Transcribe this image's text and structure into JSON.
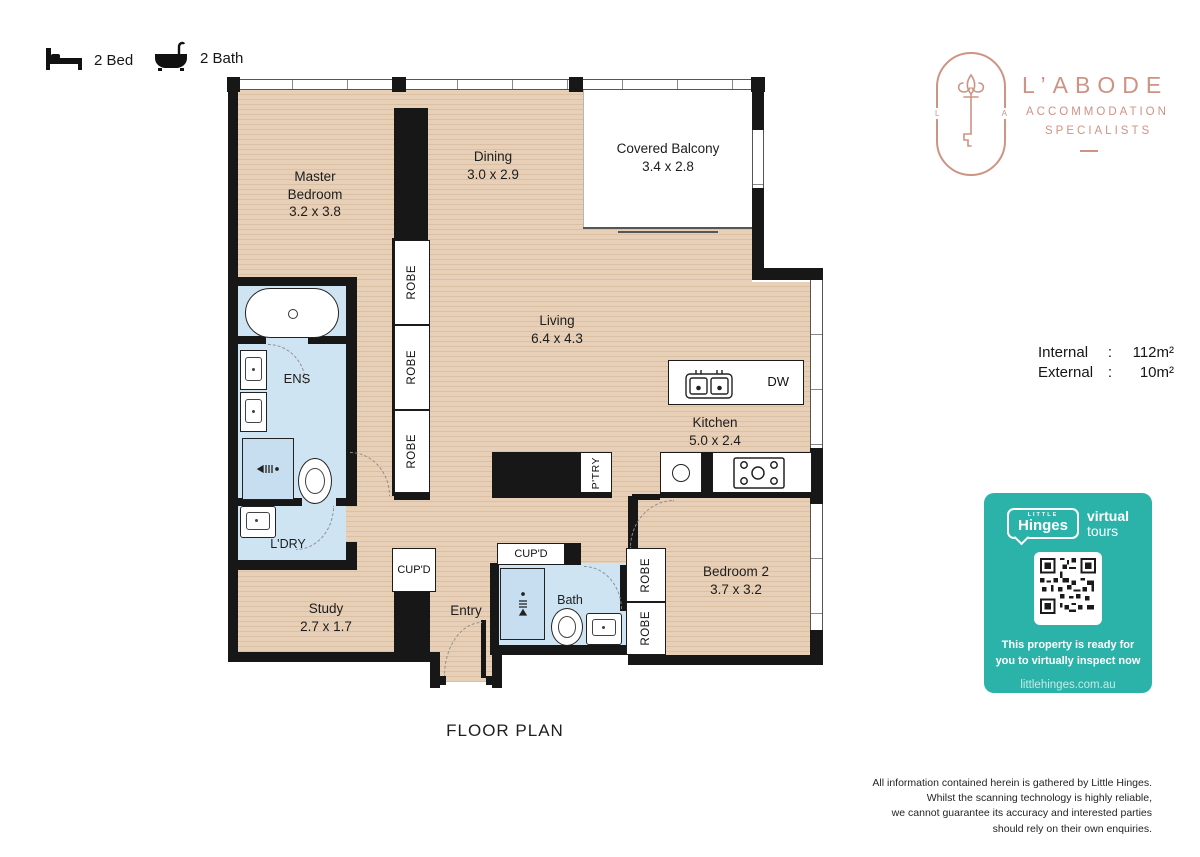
{
  "legend": {
    "bed": "2 Bed",
    "bath": "2 Bath"
  },
  "brand": {
    "name": "L’ABODE",
    "sub1": "ACCOMMODATION",
    "sub2": "SPECIALISTS",
    "mono_left": "L",
    "mono_right": "A",
    "color": "#cf9384"
  },
  "areas": {
    "internal_label": "Internal",
    "internal_colon": ":",
    "internal_value": "112m²",
    "external_label": "External",
    "external_colon": ":",
    "external_value": "10m²"
  },
  "plan": {
    "title": "FLOOR PLAN",
    "rooms": {
      "master": {
        "name_line1": "Master",
        "name_line2": "Bedroom",
        "dims": "3.2 x 3.8"
      },
      "dining": {
        "name": "Dining",
        "dims": "3.0 x 2.9"
      },
      "balcony": {
        "name": "Covered Balcony",
        "dims": "3.4 x 2.8"
      },
      "living": {
        "name": "Living",
        "dims": "6.4 x 4.3"
      },
      "kitchen": {
        "name": "Kitchen",
        "dims": "5.0 x 2.4"
      },
      "study": {
        "name": "Study",
        "dims": "2.7 x 1.7"
      },
      "bedroom2": {
        "name": "Bedroom 2",
        "dims": "3.7 x 3.2"
      },
      "ens": {
        "name": "ENS"
      },
      "ldry": {
        "name": "L'DRY"
      },
      "entry": {
        "name": "Entry"
      },
      "bath": {
        "name": "Bath"
      }
    },
    "labels": {
      "robe": "ROBE",
      "cupd": "CUP'D",
      "ptry": "P'TRY",
      "dw": "DW"
    }
  },
  "tours": {
    "brand_top": "LITTLE",
    "brand": "Hinges",
    "word1": "virtual",
    "word2": "tours",
    "message_line1": "This property is ready for",
    "message_line2": "you to virtually inspect now",
    "url": "littlehinges.com.au"
  },
  "disclaimer": {
    "lines": [
      "All information contained herein is gathered by Little Hinges.",
      "Whilst the scanning technology is highly reliable,",
      "we cannot guarantee its accuracy and interested parties",
      "should rely on their own enquiries."
    ]
  },
  "colors": {
    "floor": "#e3c7ab",
    "wet_area": "#cfe4f2",
    "wall": "#171717",
    "teal": "#2bb3aa",
    "salmon": "#cf9384"
  }
}
